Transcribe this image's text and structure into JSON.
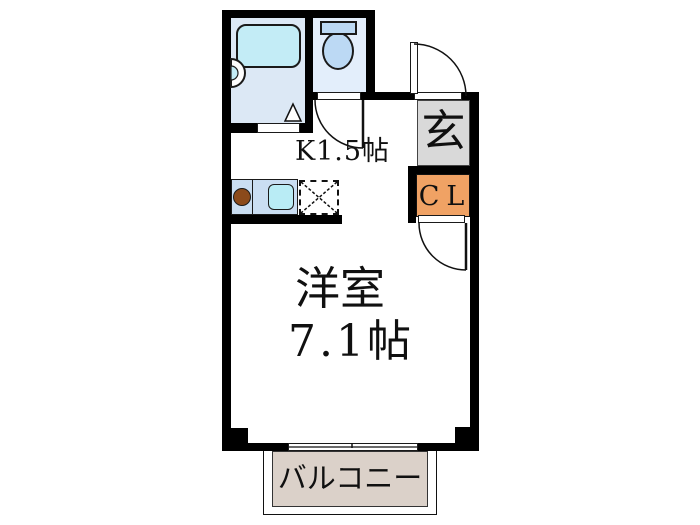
{
  "diagram_type": "japanese-apartment-floor-plan",
  "labels": {
    "kitchen": "K1.5帖",
    "entrance": "玄",
    "closet": "CL",
    "room_name": "洋室",
    "room_size": "7.1帖",
    "balcony": "バルコニー"
  },
  "rooms": [
    {
      "name": "bathroom",
      "fixtures": [
        "bathtub",
        "washbasin"
      ],
      "door": "folding-door-triangle-mark"
    },
    {
      "name": "toilet",
      "fixtures": [
        "toilet-tank",
        "toilet-bowl"
      ],
      "door": "swing-door-arc"
    },
    {
      "name": "kitchen",
      "label": "K1.5帖",
      "fixtures": [
        "stove-burner",
        "kitchen-sink",
        "appliance-space-dashed-x"
      ]
    },
    {
      "name": "entrance-genkan",
      "label": "玄",
      "door": "front-door-swing-arc"
    },
    {
      "name": "closet",
      "label": "CL",
      "door": "swing-door-arc"
    },
    {
      "name": "western-room",
      "label": "洋室",
      "size": "7.1帖",
      "window": "sliding-window"
    },
    {
      "name": "balcony",
      "label": "バルコニー"
    }
  ],
  "icons": {
    "bathtub": "rounded-rect-shape",
    "washbasin": "half-circle-shape",
    "toilet": "tank-plus-oval-bowl-shape",
    "stove-burner": "brown-circle-shape",
    "kitchen-sink": "rounded-square-shape",
    "appliance-space": "dashed-box-with-x",
    "door-swing": "quarter-circle-arc"
  },
  "colors": {
    "wall": "#000000",
    "bath_floor": "#dce8f5",
    "tub": "#c3ecf6",
    "toilet_floor": "#e3eefb",
    "toilet_fixture": "#bcd9f4",
    "counter": "#cadef2",
    "sink": "#b9ecf5",
    "burner": "#8b4a1b",
    "genkan": "#d9d9d9",
    "closet": "#f0a264",
    "balcony": "#dbd1c9"
  }
}
